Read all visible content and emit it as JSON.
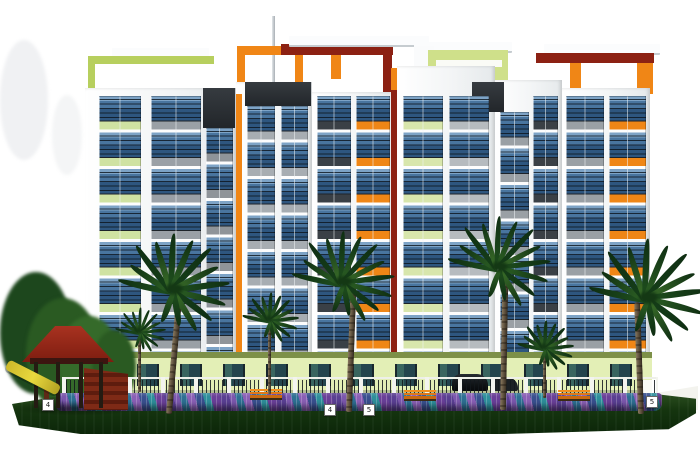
{
  "title": "residential-building-elevation-rendering",
  "markers": [
    {
      "text": "4",
      "x": 42,
      "y": 399
    },
    {
      "text": "4",
      "x": 324,
      "y": 404
    },
    {
      "text": "5",
      "x": 363,
      "y": 404
    },
    {
      "text": "5",
      "x": 646,
      "y": 396
    }
  ],
  "palette": {
    "background": "#ffffff",
    "facade_white": "#f3f5f6",
    "glass_blue": "#49759f",
    "slab_gray": "#9aa0a6",
    "slab_charcoal": "#3a4046",
    "accent_orange": "#ef8616",
    "accent_maroon": "#8c2113",
    "accent_lime": "#cfe08a",
    "ground_floor_green": "#e3efb6",
    "lawn_green": "#15350f",
    "flower_purple": "#5a3f92",
    "flower_teal": "#2e8f9b",
    "gazebo_red": "#8f2418",
    "slide_yellow": "#d9c52f",
    "bench_orange": "#e07818"
  },
  "scene": {
    "elements": [
      {
        "k": "blob",
        "name": "background-haze",
        "x": 0,
        "y": 40,
        "w": 48,
        "h": 120,
        "c": "rgba(205,210,214,0.30)"
      },
      {
        "k": "blob",
        "name": "background-haze",
        "x": 52,
        "y": 95,
        "w": 30,
        "h": 80,
        "c": "rgba(210,214,218,0.25)"
      },
      {
        "k": "mast",
        "name": "rooftop-mast",
        "x": 272,
        "y": 16,
        "w": 3,
        "h": 78
      },
      {
        "k": "slab",
        "name": "roof-slab-left",
        "x": 112,
        "y": 48,
        "w": 97,
        "h": 9
      },
      {
        "k": "frame",
        "name": "lime-pergola-frame",
        "x": 88,
        "y": 56,
        "w": 119,
        "h": 39,
        "bw": "8px 0px 0px 7px",
        "bc": "#b7cf5e"
      },
      {
        "k": "frame",
        "name": "orange-pergola-frame",
        "x": 237,
        "y": 46,
        "w": 50,
        "h": 49,
        "bw": "9px 8px 0px 8px",
        "bc": "#f08616"
      },
      {
        "k": "rect",
        "name": "maroon-roof-beam",
        "x": 281,
        "y": 44,
        "w": 112,
        "h": 11,
        "c": "#8c2113"
      },
      {
        "k": "slab",
        "name": "roof-slab-center",
        "x": 289,
        "y": 36,
        "w": 140,
        "h": 9
      },
      {
        "k": "rect",
        "name": "orange-roof-post",
        "x": 331,
        "y": 55,
        "w": 10,
        "h": 24,
        "c": "#f08616"
      },
      {
        "k": "rect",
        "name": "maroon-roof-post",
        "x": 383,
        "y": 55,
        "w": 9,
        "h": 40,
        "c": "#8c2113"
      },
      {
        "k": "slab",
        "name": "roof-slab-penthouse",
        "x": 414,
        "y": 42,
        "w": 98,
        "h": 9
      },
      {
        "k": "rect",
        "name": "penthouse-spine",
        "x": 414,
        "y": 46,
        "w": 20,
        "h": 28,
        "c": "#fafbfc"
      },
      {
        "k": "rect",
        "name": "penthouse-lime-block",
        "x": 428,
        "y": 50,
        "w": 80,
        "h": 46,
        "c": "#cfe08a"
      },
      {
        "k": "rect",
        "name": "penthouse-white-band",
        "x": 436,
        "y": 60,
        "w": 66,
        "h": 7,
        "c": "#fafbf6"
      },
      {
        "k": "slab",
        "name": "roof-slab-right",
        "x": 544,
        "y": 44,
        "w": 116,
        "h": 9
      },
      {
        "k": "rect",
        "name": "maroon-roof-beam-right",
        "x": 536,
        "y": 53,
        "w": 118,
        "h": 10,
        "c": "#8c2113"
      },
      {
        "k": "rect",
        "name": "orange-roof-post-right",
        "x": 570,
        "y": 63,
        "w": 11,
        "h": 26,
        "c": "#f08616"
      },
      {
        "k": "rect",
        "name": "orange-roof-corner-post",
        "x": 637,
        "y": 63,
        "w": 16,
        "h": 31,
        "c": "#f08616"
      },
      {
        "k": "tower",
        "name": "tower-1",
        "x": 85,
        "y": 88,
        "w": 151,
        "h": 266
      },
      {
        "k": "tower",
        "name": "tower-2",
        "x": 236,
        "y": 82,
        "w": 76,
        "h": 272
      },
      {
        "k": "tower",
        "name": "tower-3",
        "x": 312,
        "y": 92,
        "w": 85,
        "h": 262
      },
      {
        "k": "tower",
        "name": "tower-4",
        "x": 397,
        "y": 66,
        "w": 98,
        "h": 288
      },
      {
        "k": "tower",
        "name": "tower-5",
        "x": 495,
        "y": 80,
        "w": 67,
        "h": 274
      },
      {
        "k": "tower",
        "name": "tower-6",
        "x": 562,
        "y": 88,
        "w": 88,
        "h": 266
      },
      {
        "k": "header",
        "name": "facade-dark-header",
        "x": 203,
        "y": 88,
        "w": 32,
        "h": 40
      },
      {
        "k": "header",
        "name": "facade-dark-header",
        "x": 245,
        "y": 82,
        "w": 66,
        "h": 24
      },
      {
        "k": "header",
        "name": "facade-dark-header",
        "x": 472,
        "y": 82,
        "w": 32,
        "h": 30
      },
      {
        "k": "rect",
        "name": "orange-accent-strip",
        "x": 236,
        "y": 94,
        "w": 6,
        "h": 260,
        "c": "#f08616"
      },
      {
        "k": "rect",
        "name": "maroon-accent-strip",
        "x": 391,
        "y": 74,
        "w": 6,
        "h": 280,
        "c": "#8c2113"
      },
      {
        "k": "rect",
        "name": "orange-accent-patch",
        "x": 391,
        "y": 68,
        "w": 6,
        "h": 22,
        "c": "#f08616"
      },
      {
        "k": "bay",
        "name": "balcony-bay",
        "x": 99,
        "y": 96,
        "w": 42,
        "h": 256,
        "sl": "#cfe2a2"
      },
      {
        "k": "bay",
        "name": "balcony-bay",
        "x": 151,
        "y": 96,
        "w": 50,
        "h": 256,
        "sl": "#9aa0a6"
      },
      {
        "k": "bay",
        "name": "balcony-bay",
        "x": 206,
        "y": 128,
        "w": 27,
        "h": 224,
        "sl": "#8f9499"
      },
      {
        "k": "bay",
        "name": "balcony-bay",
        "x": 247,
        "y": 106,
        "w": 28,
        "h": 246,
        "sl": "#a7adb2"
      },
      {
        "k": "bay",
        "name": "balcony-bay",
        "x": 281,
        "y": 106,
        "w": 27,
        "h": 246,
        "sl": "#a7adb2"
      },
      {
        "k": "bay",
        "name": "balcony-bay",
        "x": 317,
        "y": 96,
        "w": 34,
        "h": 256,
        "sl": "#3a4046"
      },
      {
        "k": "bay",
        "name": "balcony-bay-orange",
        "x": 356,
        "y": 96,
        "w": 34,
        "h": 256,
        "sl": "#ef8616"
      },
      {
        "k": "bay",
        "name": "balcony-bay",
        "x": 403,
        "y": 96,
        "w": 40,
        "h": 256,
        "sl": "#d8e6ac"
      },
      {
        "k": "bay",
        "name": "balcony-bay",
        "x": 449,
        "y": 96,
        "w": 40,
        "h": 256,
        "sl": "#b6bbbf"
      },
      {
        "k": "bay",
        "name": "balcony-bay",
        "x": 500,
        "y": 112,
        "w": 29,
        "h": 240,
        "sl": "#9aa0a5"
      },
      {
        "k": "bay",
        "name": "balcony-bay",
        "x": 533,
        "y": 96,
        "w": 25,
        "h": 256,
        "sl": "#3a4046"
      },
      {
        "k": "bay",
        "name": "balcony-bay",
        "x": 566,
        "y": 96,
        "w": 38,
        "h": 256,
        "sl": "#9aa0a5"
      },
      {
        "k": "bay",
        "name": "balcony-bay-orange",
        "x": 609,
        "y": 96,
        "w": 37,
        "h": 256,
        "sl": "#ef8616"
      },
      {
        "k": "rect",
        "name": "ground-floor-band",
        "x": 86,
        "y": 352,
        "w": 566,
        "h": 6,
        "c": "#7d9048"
      },
      {
        "k": "rect",
        "name": "ground-floor-wall",
        "x": 86,
        "y": 358,
        "w": 566,
        "h": 36,
        "c": "#e3efb6"
      },
      {
        "k": "gf",
        "name": "ground-floor-windows",
        "x": 94,
        "y": 364,
        "w": 550,
        "h": 22
      },
      {
        "k": "rect",
        "name": "building-base-shadow",
        "x": 86,
        "y": 390,
        "w": 566,
        "h": 5,
        "c": "rgba(90,100,80,0.35)"
      },
      {
        "k": "blob",
        "name": "background-tree",
        "x": 0,
        "y": 272,
        "w": 72,
        "h": 122,
        "c": "#1d471d"
      },
      {
        "k": "blob",
        "name": "background-tree",
        "x": 26,
        "y": 298,
        "w": 74,
        "h": 112,
        "c": "#2a5a22"
      },
      {
        "k": "blob",
        "name": "background-tree",
        "x": 58,
        "y": 316,
        "w": 62,
        "h": 92,
        "c": "#356a2a"
      },
      {
        "k": "blob",
        "name": "background-tree",
        "x": 92,
        "y": 330,
        "w": 44,
        "h": 74,
        "c": "#2a5a22"
      },
      {
        "k": "car",
        "name": "parked-car",
        "x": 452,
        "y": 374,
        "w": 36,
        "h": 17
      },
      {
        "k": "car",
        "name": "parked-car",
        "x": 492,
        "y": 377,
        "w": 26,
        "h": 14,
        "c": "#1b2024"
      },
      {
        "k": "fence",
        "name": "compound-fence",
        "x": 62,
        "y": 377,
        "w": 596,
        "h": 22
      },
      {
        "k": "rect",
        "name": "compound-wall",
        "x": 648,
        "y": 386,
        "w": 50,
        "h": 24,
        "c": "#f3f3ee",
        "cp": "polygon(0 35%, 100% 0, 100% 100%, 0 100%)"
      },
      {
        "k": "rect",
        "name": "gate-pillar",
        "x": 643,
        "y": 380,
        "w": 9,
        "h": 30,
        "c": "#fafaf5"
      },
      {
        "k": "lawn",
        "name": "lawn",
        "x": 12,
        "y": 394,
        "w": 684,
        "h": 40
      },
      {
        "k": "flowers",
        "name": "flower-bed",
        "x": 56,
        "y": 393,
        "w": 606,
        "h": 18
      },
      {
        "k": "bench",
        "name": "garden-bench",
        "x": 250,
        "y": 389,
        "w": 32,
        "h": 11
      },
      {
        "k": "bench",
        "name": "garden-bench",
        "x": 404,
        "y": 390,
        "w": 32,
        "h": 11
      },
      {
        "k": "bench",
        "name": "garden-bench",
        "x": 558,
        "y": 390,
        "w": 32,
        "h": 11
      },
      {
        "k": "shadow",
        "name": "playground-shadow",
        "x": 12,
        "y": 400,
        "w": 130,
        "h": 16
      },
      {
        "k": "stairs",
        "name": "playground-stairs",
        "x": 84,
        "y": 368,
        "w": 44,
        "h": 42
      },
      {
        "k": "proof",
        "name": "gazebo-roof",
        "x": 22,
        "y": 326,
        "w": 92,
        "h": 36
      },
      {
        "k": "rect",
        "name": "gazebo-roof-band",
        "x": 30,
        "y": 358,
        "w": 78,
        "h": 6,
        "c": "#3c1510"
      },
      {
        "k": "rect",
        "name": "gazebo-post",
        "x": 34,
        "y": 362,
        "w": 4,
        "h": 46,
        "c": "#241b12"
      },
      {
        "k": "rect",
        "name": "gazebo-post",
        "x": 56,
        "y": 362,
        "w": 4,
        "h": 46,
        "c": "#241b12"
      },
      {
        "k": "rect",
        "name": "gazebo-post",
        "x": 79,
        "y": 362,
        "w": 4,
        "h": 46,
        "c": "#241b12"
      },
      {
        "k": "rect",
        "name": "gazebo-post",
        "x": 99,
        "y": 362,
        "w": 4,
        "h": 46,
        "c": "#241b12"
      },
      {
        "k": "rect",
        "name": "slide-support",
        "x": 44,
        "y": 388,
        "w": 5,
        "h": 22,
        "c": "#5e2a16"
      },
      {
        "k": "slide",
        "name": "playground-slide",
        "x": 4,
        "y": 372,
        "w": 58,
        "h": 11,
        "r": 27
      }
    ],
    "palms": [
      {
        "name": "palm-tree",
        "x": 172,
        "y": 288,
        "s": 1.0,
        "tx": 166,
        "tb": 414,
        "lean": 5
      },
      {
        "name": "palm-tree",
        "x": 342,
        "y": 281,
        "s": 0.92,
        "tx": 346,
        "tb": 412,
        "lean": 2
      },
      {
        "name": "palm-tree",
        "x": 498,
        "y": 266,
        "s": 0.92,
        "tx": 500,
        "tb": 410,
        "lean": 1
      },
      {
        "name": "palm-tree",
        "x": 646,
        "y": 296,
        "s": 1.05,
        "tx": 638,
        "tb": 414,
        "lean": -2
      },
      {
        "name": "palm-tree-small",
        "x": 140,
        "y": 332,
        "s": 0.45,
        "tx": 138,
        "tb": 392,
        "lean": 0
      },
      {
        "name": "palm-tree-small",
        "x": 270,
        "y": 320,
        "s": 0.5,
        "tx": 268,
        "tb": 394,
        "lean": 0
      },
      {
        "name": "palm-tree-small",
        "x": 545,
        "y": 348,
        "s": 0.5,
        "tx": 543,
        "tb": 398,
        "lean": 0
      }
    ],
    "frond_angles": [
      -170,
      -150,
      -130,
      -110,
      -90,
      -70,
      -50,
      -30,
      -10,
      12,
      34,
      56,
      75,
      105
    ],
    "frond_lengths": [
      0.95,
      0.85,
      1,
      0.9,
      1,
      0.95,
      1,
      0.9,
      1,
      0.95,
      0.85,
      0.8,
      0.6,
      0.55
    ],
    "frond_colors": [
      "#20511f",
      "#2f6426",
      "#16401a",
      "#3f752c"
    ]
  }
}
